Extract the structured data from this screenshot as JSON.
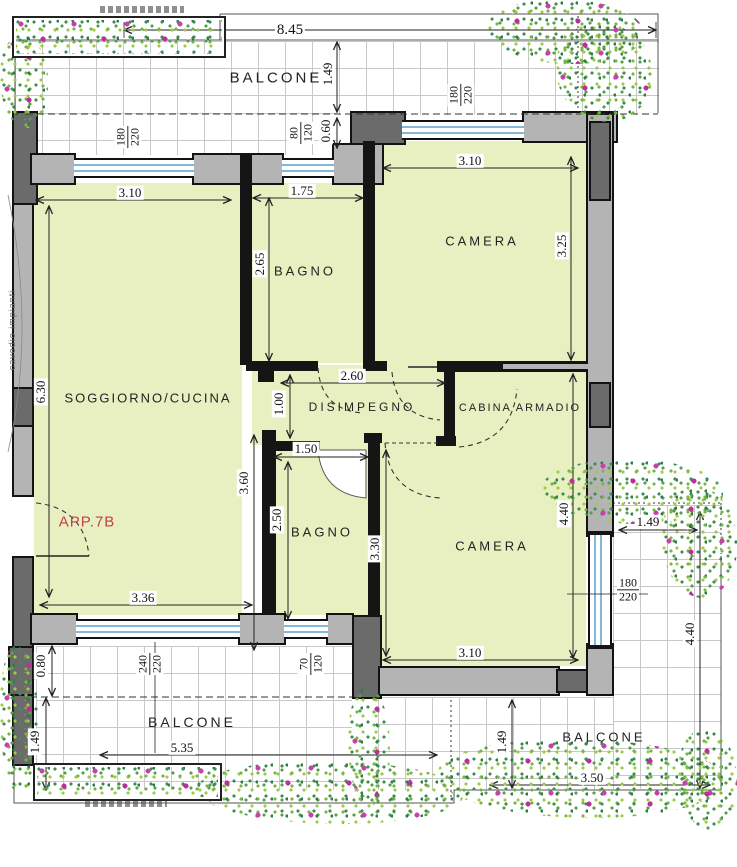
{
  "apartment": {
    "label": "APP.7B",
    "annotation": "cavedio impianti"
  },
  "rooms": {
    "soggiorno": {
      "label": "SOGGIORNO/CUCINA"
    },
    "bagno1": {
      "label": "BAGNO"
    },
    "camera1": {
      "label": "CAMERA"
    },
    "disimpegno": {
      "label": "DISIMPEGNO"
    },
    "cabina": {
      "label": "CABINA ARMADIO"
    },
    "bagno2": {
      "label": "BAGNO"
    },
    "camera2": {
      "label": "CAMERA"
    },
    "balcone_top": {
      "label": "BALCONE"
    },
    "balcone_sw": {
      "label": "BALCONE"
    },
    "balcone_se": {
      "label": "BALCONE"
    }
  },
  "dims": {
    "top_total": "8.45",
    "balc_top_depth": "1.49",
    "balc_top_step": "0.60",
    "sogg_w": "3.10",
    "sogg_h": "6.30",
    "sogg_lower_w": "3.36",
    "sogg_lower_h": "3.60",
    "bagno1_w": "1.75",
    "bagno1_h": "2.65",
    "cam1_w": "3.10",
    "cam1_h": "3.25",
    "disimp_w": "2.60",
    "disimp_h": "1.00",
    "bagno2_w": "1.50",
    "bagno2_h": "2.50",
    "cam2_h_left": "3.30",
    "cam2_h_right": "4.40",
    "cam2_w": "3.10",
    "balc_sw_step": "0.80",
    "balc_sw_depth": "1.49",
    "balc_sw_w": "5.35",
    "balc_se_top_w": "1.49",
    "balc_se_h": "4.40",
    "balc_se_w": "3.50",
    "balc_se_depth": "1.49"
  },
  "windows": {
    "sogg_top": {
      "num": "180",
      "den": "220"
    },
    "bagno1_top": {
      "num": "80",
      "den": "120"
    },
    "cam1_top": {
      "num": "180",
      "den": "220"
    },
    "sogg_bottom": {
      "num": "240",
      "den": "220"
    },
    "bagno2_bottom": {
      "num": "70",
      "den": "120"
    },
    "cam2_right": {
      "num": "180",
      "den": "220"
    }
  },
  "colors": {
    "room_fill": "#e8f0c2",
    "wall_gray": "#b4b4b4",
    "pillar_dark": "#6b6b6b",
    "window_blue": "#85b7d6",
    "accent_label": "#c2404a",
    "plant_green": "#57a04b",
    "flower_magenta": "#c93fae"
  }
}
